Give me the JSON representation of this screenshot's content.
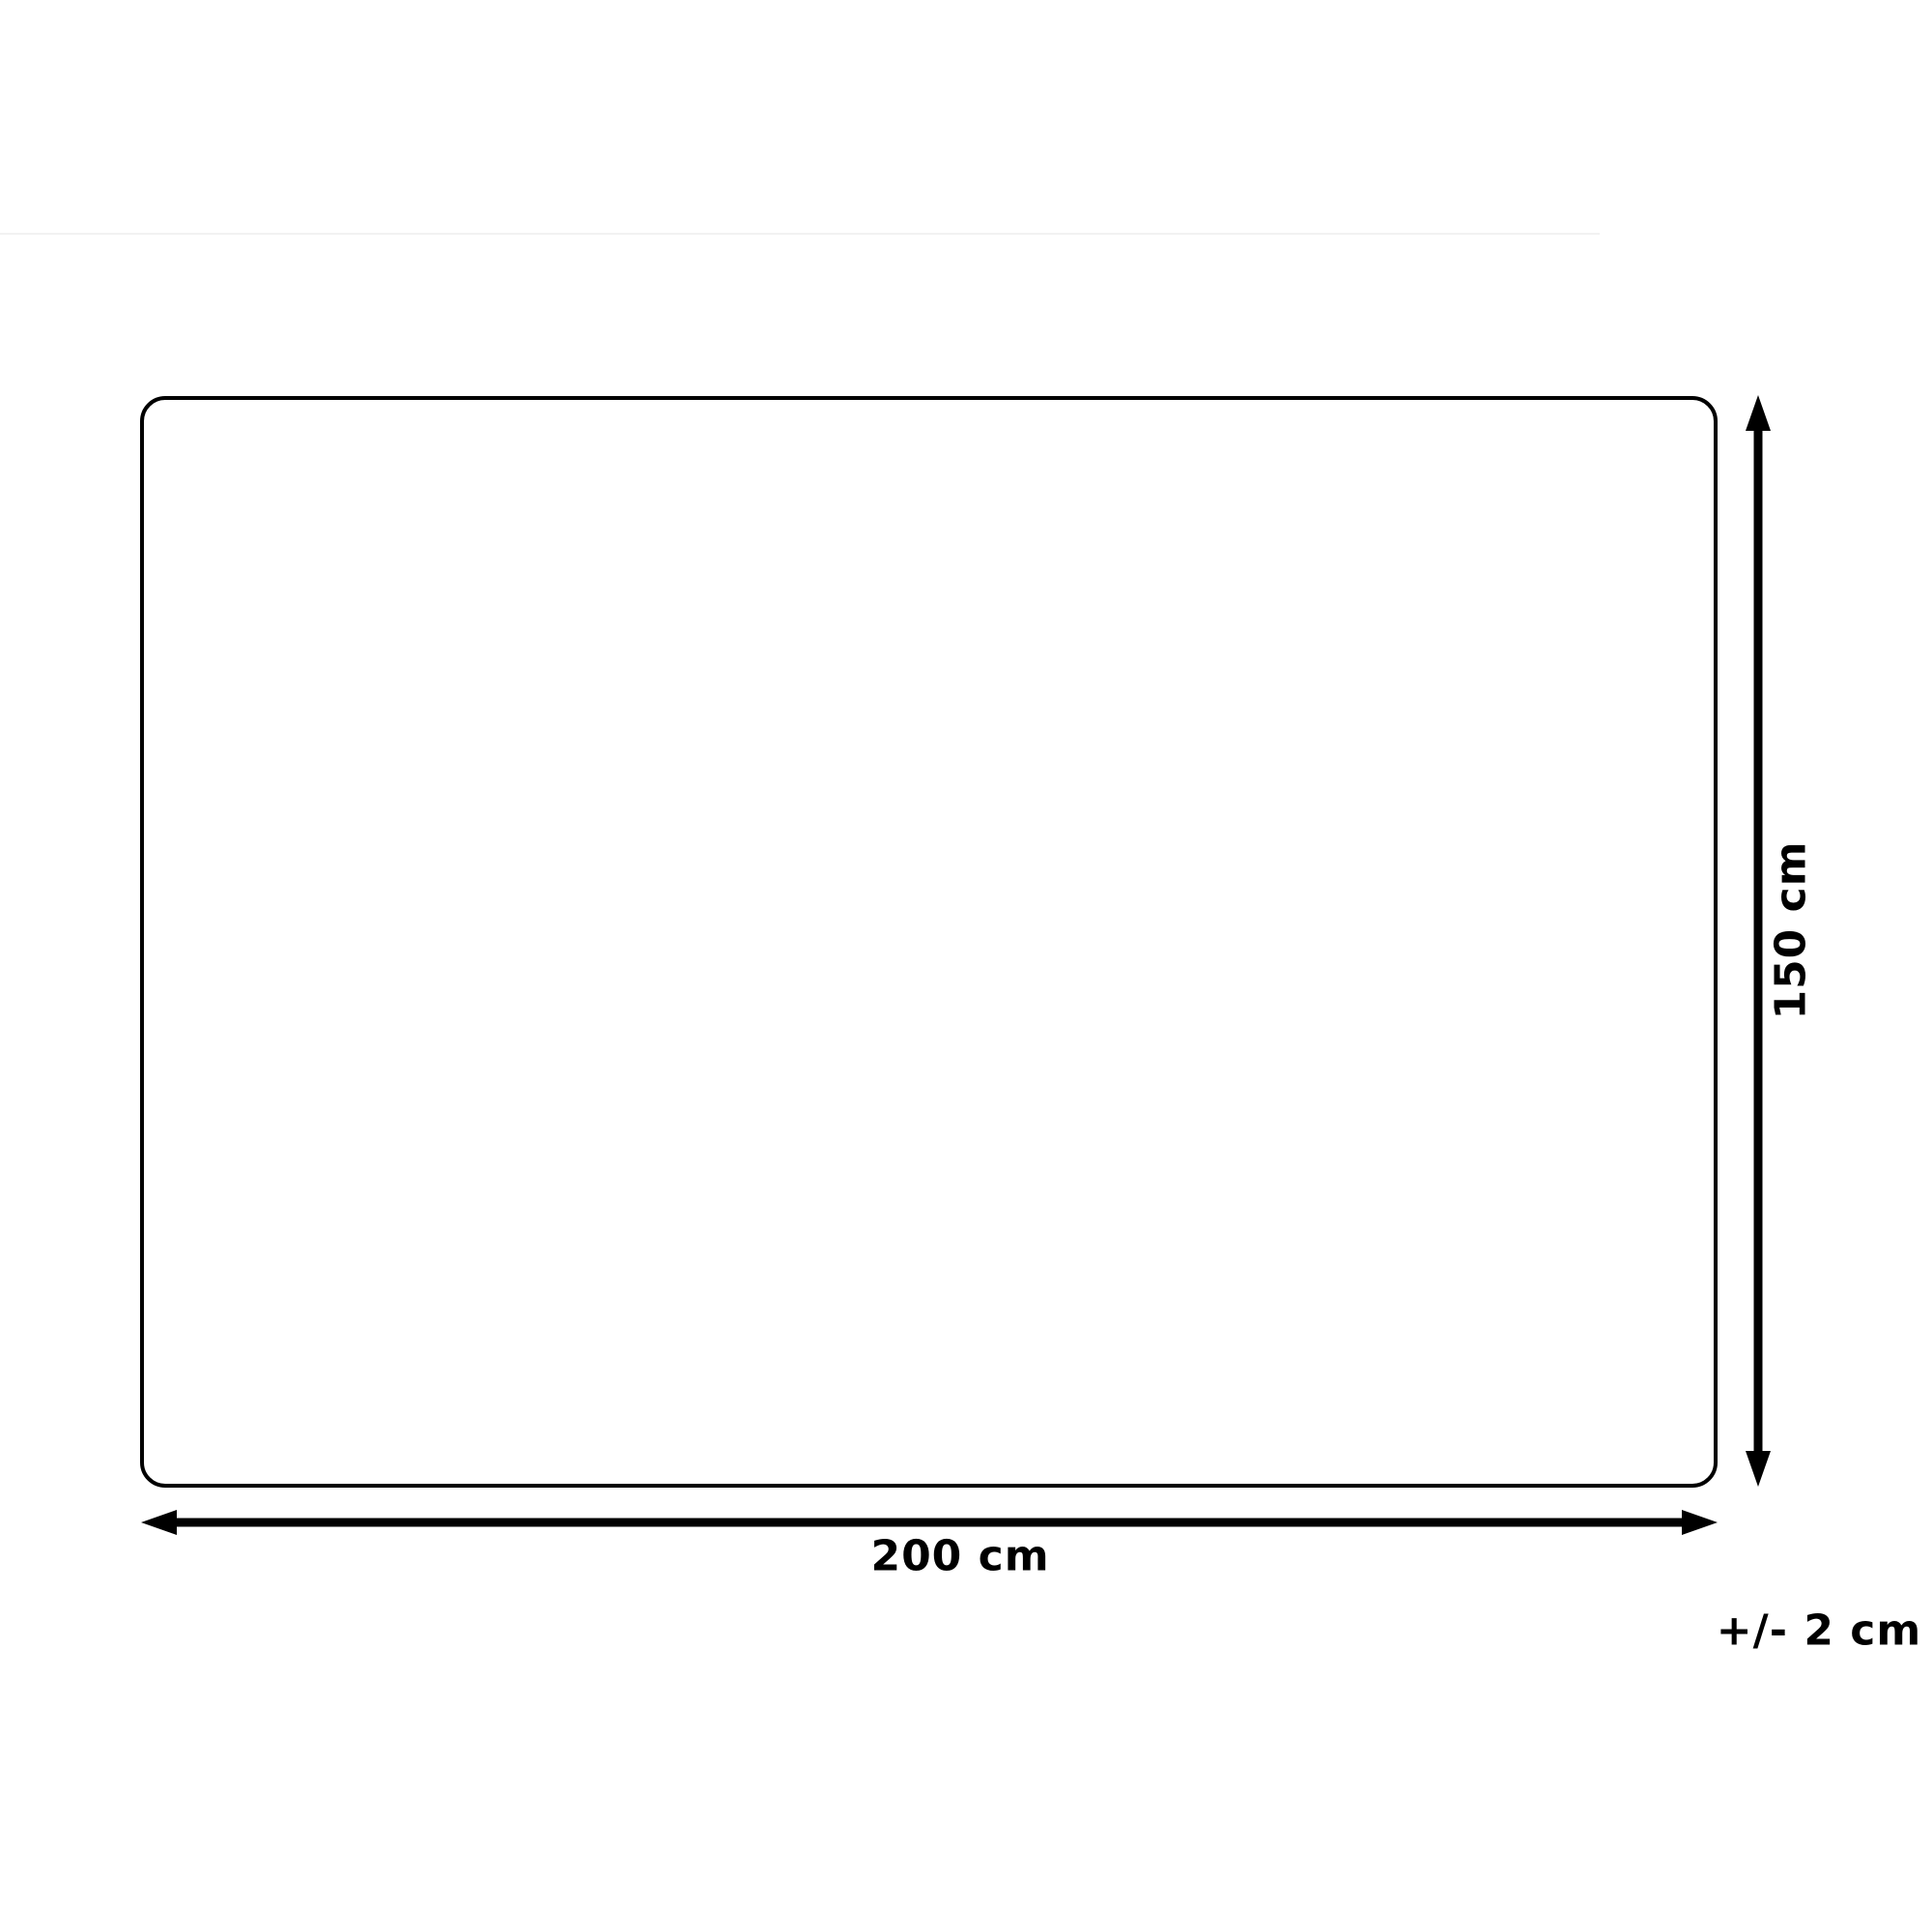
{
  "page": {
    "background_color": "#ffffff",
    "top_divider_color": "#f2f2f2"
  },
  "diagram": {
    "type": "product-dimension-diagram",
    "shape": "rounded-rectangle",
    "outline_color": "#000000",
    "arrow_color": "#000000",
    "label_color": "#000000",
    "width_label": "200 cm",
    "height_label": "150 cm",
    "tolerance_label": "+/- 2 cm"
  }
}
